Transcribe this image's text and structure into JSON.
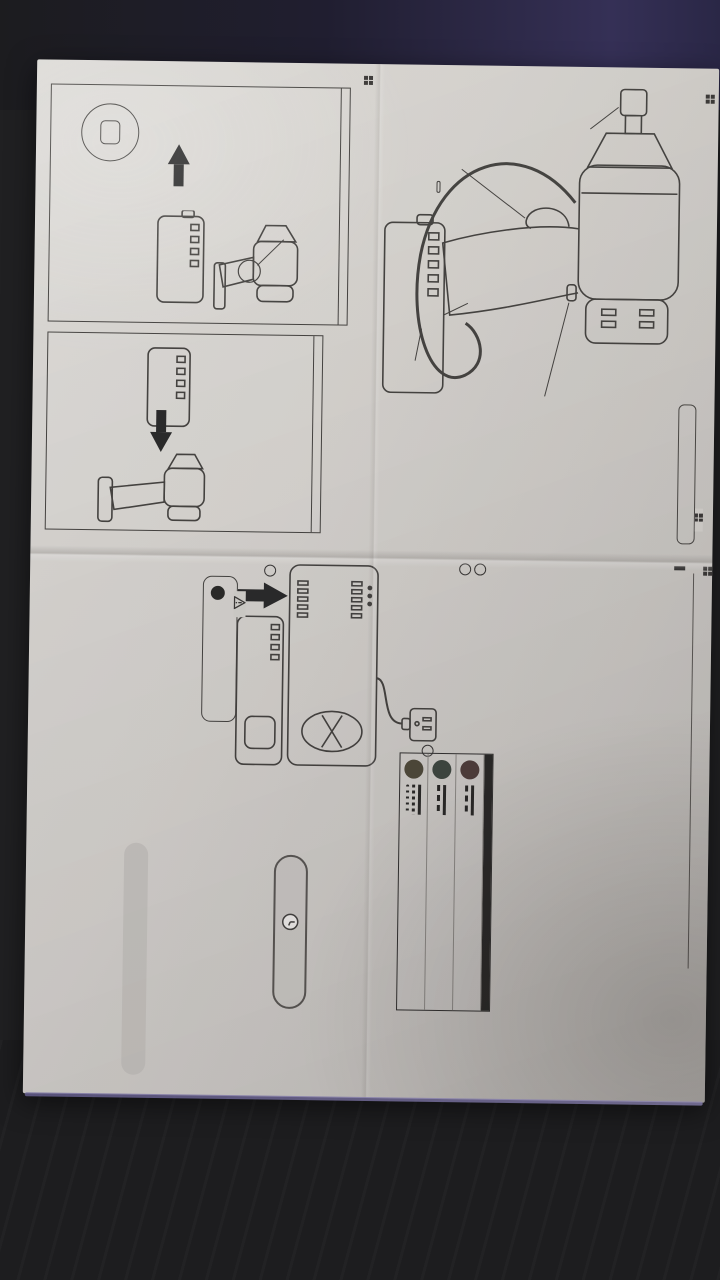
{
  "photo": {
    "floor_color": "#1d1d1f",
    "paper_color": "#d5d2cd",
    "paper_edge_tint": "#8d85b5"
  },
  "parts": {
    "title": "各部の名称",
    "labels": {
      "drive": "差込角\n1/2\"(12.7mm)",
      "trigger": "トリガー",
      "switch": "回転方向\n切替レバー",
      "battery": "19.2V\nバッテリー",
      "strap": "ストラップ",
      "accessory_title": "付属品",
      "accessory_item": "バッテリー充電器"
    },
    "spec": {
      "title": "仕様",
      "lines": [
        "バッテリー:DC 19.2V/2.0Ah\n ニッケル水素電池",
        "差込角:1/2\"(12.7mm)",
        "無負荷回転数:1,800rpm",
        "最大トルク:600Nm",
        "全長:225mm",
        "重量:2.7kg"
      ]
    }
  },
  "attach": {
    "title": "バッテリーの取り付け・取り外し",
    "removal": {
      "heading": "取り外し",
      "step1": "1.回転方向切替ボタンを\nロック(中央)の位置にします",
      "step2": "2.左右2ヶ所のボタンを\n押さえながらスライド\nさせます"
    },
    "install": {
      "heading": "取り付け",
      "text": "溝に合わせて「カチッ」と\nフックが掛かる奥まで\nしっかりと差し込みます"
    }
  },
  "charge": {
    "title": "バッテリーを充電する",
    "request_label": "お願い",
    "notes": [
      {
        "text": "・充電は気温が10〜40℃の範囲で行ってください。"
      },
      {
        "text": "・使用直後の熱いバッテリーは充電できない場合があります。その場合はバッテリーが冷えてから充電してください。"
      },
      {
        "pre": "・新品のバッテリーや、長期間使用しなかったバッテリーはフル充電できませんが、",
        "highlight": "これは異常ではありません。",
        "post": "数回の完全放電(バッテリーを使い切る)と充電を繰り返すとフル充電できるようになります。"
      },
      {
        "text": "・連続して2個以上のバッテリーを充電する場合は、充電器の保護のため15分以上間隔をあけて充電してください。"
      },
      {
        "text": "・充電後は、充電器の電源プラグをコンセントから抜いてください。"
      }
    ],
    "steps": [
      {
        "no": "1",
        "text": "充電器の電源プラグをコンセントに差します"
      },
      {
        "no": "2",
        "text": "バッテリーを充電器の奥まで\nしっかりと差し込みます"
      }
    ],
    "outlet": {
      "no": "1",
      "line1": "AC100V",
      "line2": "50/60Hz"
    },
    "insert_no": "2"
  },
  "led": {
    "title": "充電状況とLEDの点灯",
    "rows": [
      {
        "label": "赤",
        "color": "#4a3835",
        "entries": [
          {
            "style": "solid",
            "text": "点灯…充電器通電中"
          },
          {
            "style": "dash",
            "text": "点滅…バッテリーの性能低下"
          }
        ]
      },
      {
        "label": "緑",
        "color": "#39423a",
        "entries": [
          {
            "style": "solid",
            "text": "点灯…正常な充電中"
          },
          {
            "style": "dash",
            "text": "点滅…充電完了(維持充電中)"
          }
        ]
      },
      {
        "label": "黄",
        "color": "#4a4434",
        "entries": [
          {
            "style": "solid",
            "text": "点灯…エラー"
          },
          {
            "style": "fine",
            "text": "早い点滅…バッテリーの温度高い"
          },
          {
            "style": "dots",
            "text": "遅い点滅…バッテリーの温度低い"
          }
        ]
      }
    ]
  },
  "time": {
    "label": "充電時間",
    "approx": "約",
    "value": "1",
    "unit": "時間"
  },
  "warning": {
    "title": "警告",
    "mark": "!",
    "text": "雨中など、水にぬれる環境で充電しないこと"
  },
  "longevity": {
    "title": "バッテリーを長持ちさせるには",
    "body": "バッテリーは消耗品のため、充放電を繰り返すと、徐々に性能が低下します。寿命を最大限の性能で使用するために、右記に留意ください。",
    "tips": [
      "・電池容量が十分にある場合は充電しない",
      "・機器が動かなくなる手前で充電し過放電はしない"
    ]
  }
}
